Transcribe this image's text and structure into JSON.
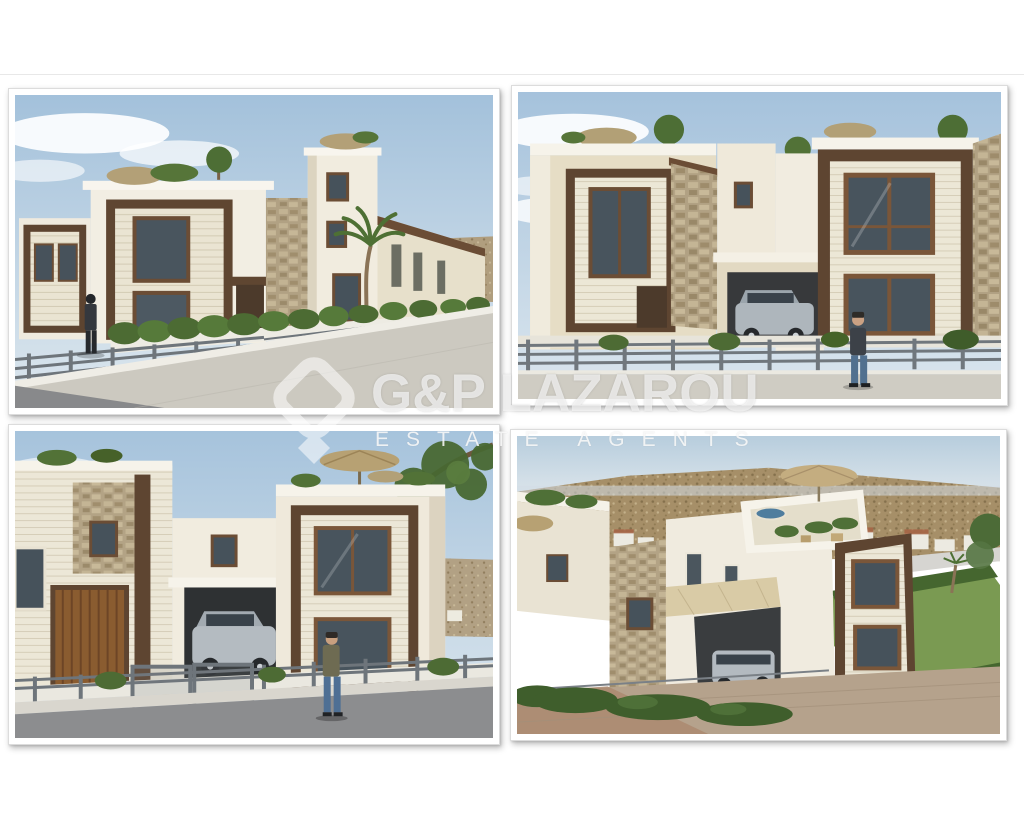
{
  "page": {
    "background_color": "#ffffff",
    "divider_color": "#e8e8e8"
  },
  "watermark": {
    "title": "G&P LAZAROU",
    "subtitle": "ESTATE AGENTS",
    "logo_icon": "diamond-house-logo",
    "text_color": "#fafafa",
    "opacity": 0.65
  },
  "gallery": {
    "photos": [
      {
        "id": "top-left",
        "description": "3D render, street corner view of modern white villas with dark timber frames, stone pillar, roof gardens, palm tree, hedge behind grey railing, pedestrian on sidewalk"
      },
      {
        "id": "top-right",
        "description": "3D render, front view of two villas with dark timber window frames, stone pillar, carport with silver car, pedestrian walking along grey railing"
      },
      {
        "id": "bottom-left",
        "description": "3D render, villas with timber garage door, silver car behind railing gate, standing figure, hillside village and tree branch in background"
      },
      {
        "id": "bottom-right",
        "description": "3D render, aerial view of villa with roof terrace, parasol, carport with car, lawn and hedges, town and scrub hillside in background"
      }
    ]
  },
  "palette": {
    "sky_blue": "#a3c1db",
    "wall_white": "#f1ede2",
    "wall_beige": "#e5dcc4",
    "timber_brown": "#5e4531",
    "stone_tan": "#b1a183",
    "hedge_green": "#4c6b33",
    "road_grey": "#8c8d8f",
    "car_silver": "#b4bbc1",
    "watermark_white": "#ffffff"
  }
}
